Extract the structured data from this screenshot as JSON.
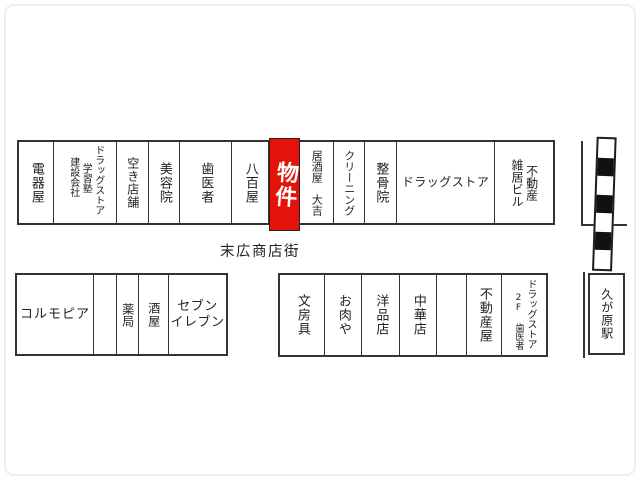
{
  "street": {
    "label": "末広商店街"
  },
  "station": {
    "label": "久が原駅"
  },
  "property_highlight": {
    "label": "物件",
    "color": "#e41208"
  },
  "rows": {
    "top": [
      {
        "name": "electric-appliance-shop",
        "lines": [
          "電器屋"
        ]
      },
      {
        "name": "drugstore-cramschool-construction",
        "lines": [
          "ドラッグストア",
          "学習塾",
          "建設会社"
        ]
      },
      {
        "name": "vacant-store",
        "lines": [
          "空き店舗"
        ]
      },
      {
        "name": "beauty-salon",
        "lines": [
          "美容院"
        ]
      },
      {
        "name": "dentist",
        "lines": [
          "歯医者"
        ]
      },
      {
        "name": "greengrocer",
        "lines": [
          "八百屋"
        ]
      },
      {
        "name": "property-highlight",
        "lines": [
          "物件"
        ],
        "highlight": true
      },
      {
        "name": "izakaya-daikichi",
        "lines": [
          "居酒屋　大吉"
        ]
      },
      {
        "name": "dry-cleaner",
        "lines": [
          "クリーニング"
        ]
      },
      {
        "name": "osteopathic-clinic",
        "lines": [
          "整骨院"
        ]
      },
      {
        "name": "drugstore",
        "lines": [
          "ドラッグストア"
        ]
      },
      {
        "name": "real-estate-mixed-building",
        "lines": [
          "不動産",
          "雑居ビル"
        ]
      }
    ],
    "bottom_left": [
      {
        "name": "colmopia-clothing-store",
        "lines": [
          "コルモピア"
        ]
      },
      {
        "name": "unlabeled-unit",
        "lines": []
      },
      {
        "name": "pharmacy",
        "lines": [
          "薬局"
        ]
      },
      {
        "name": "liquor-store",
        "lines": [
          "酒屋"
        ]
      },
      {
        "name": "seven-eleven",
        "lines": [
          "セブン",
          "イレブン"
        ]
      }
    ],
    "bottom_right": [
      {
        "name": "stationery-store",
        "lines": [
          "文房具"
        ]
      },
      {
        "name": "butcher-shop",
        "lines": [
          "お肉や"
        ]
      },
      {
        "name": "clothing-store",
        "lines": [
          "洋品店"
        ]
      },
      {
        "name": "chinese-restaurant",
        "lines": [
          "中華店"
        ]
      },
      {
        "name": "unlabeled-unit",
        "lines": []
      },
      {
        "name": "real-estate-agency",
        "lines": [
          "不動産屋"
        ]
      },
      {
        "name": "drugstore-2f-dentist",
        "lines": [
          "ドラッグストア",
          "2F 歯医者"
        ]
      }
    ]
  }
}
